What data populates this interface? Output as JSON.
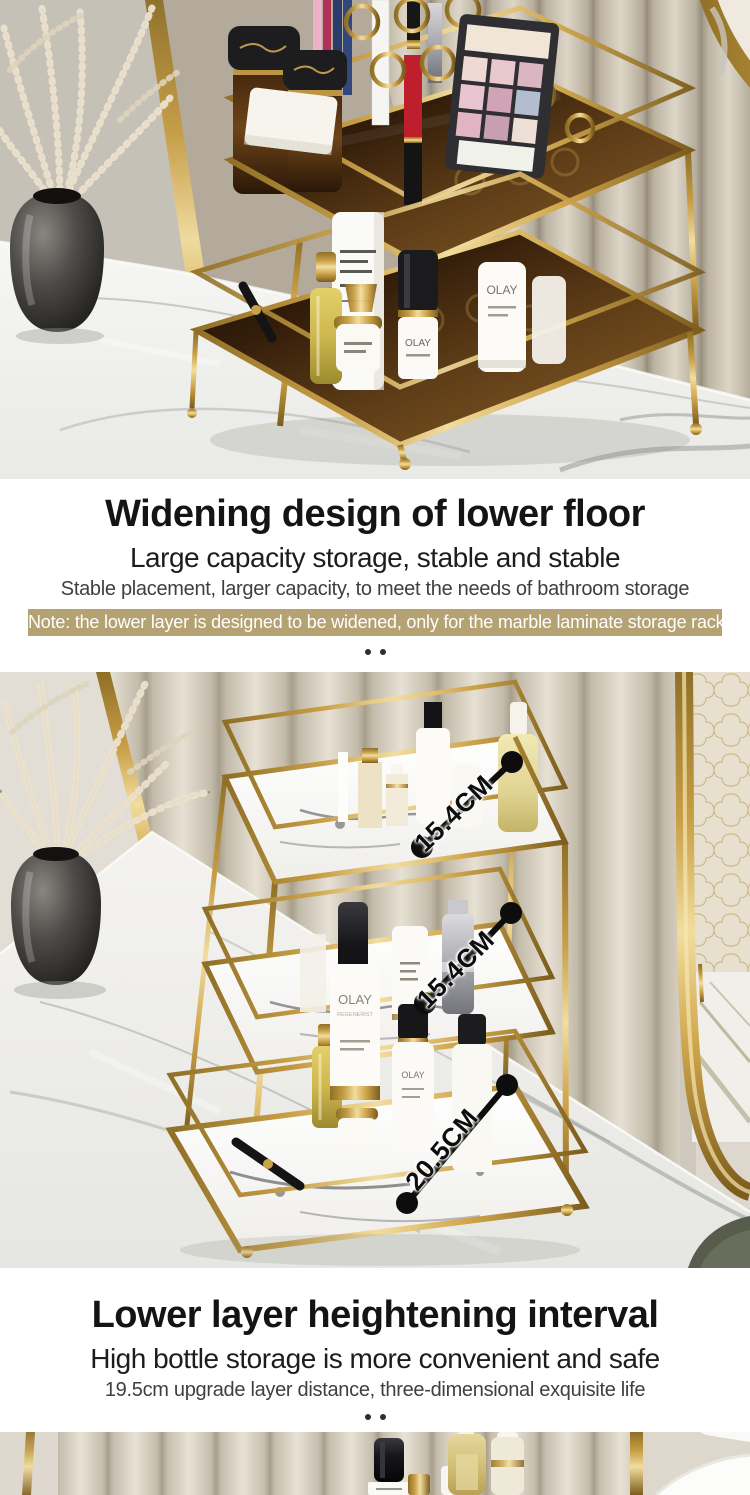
{
  "colors": {
    "note_background": "#b5a273",
    "gold_accent": "#c9a24b",
    "heading_text": "#141414",
    "body_text": "#3f3f3f",
    "measure_line": "#0d0d0d"
  },
  "section1": {
    "title": "Widening design of lower floor",
    "subtitle": "Large capacity storage, stable and stable",
    "description": "Stable placement, larger capacity, to meet the needs of bathroom storage",
    "note": "Note: the lower layer is designed to be widened, only for the marble laminate storage rack"
  },
  "section2": {
    "title": "Lower layer heightening interval",
    "subtitle": "High bottle storage is more convenient and safe",
    "description": "19.5cm upgrade layer distance, three-dimensional exquisite life"
  },
  "measurements": {
    "tier1": "15.4CM",
    "tier2": "15.4CM",
    "tier3": "20.5CM"
  },
  "brand": {
    "olay": "OLAY",
    "olay_series": "REGENERIST"
  }
}
